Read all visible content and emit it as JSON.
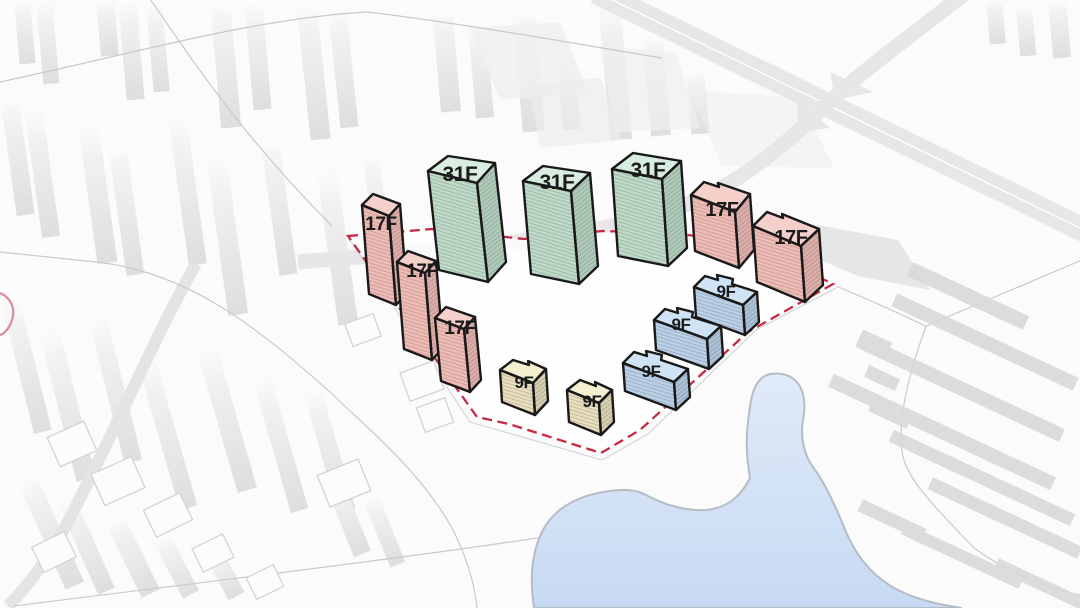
{
  "diagram": {
    "kind": "residential-site-massing-aerial-diagram",
    "site": {
      "boundary_style": "dashed",
      "boundary_color": "#c62a44"
    }
  },
  "colors": {
    "background": "#fbfbfb",
    "outline": "#191919",
    "label": "#1b1b1b",
    "boundary": "#c62a44",
    "water": "#cfdff4",
    "water_deep": "#c7daf3",
    "water_edge": "#b5bcc5",
    "road": "#e7e7e9",
    "road_line": "#c9c9cd",
    "context_building": "#d9d9db",
    "green_roof": "#d8ecdf",
    "green_face": "#bddcc9",
    "pink_roof": "#f5cfc9",
    "pink_face": "#efbdb7",
    "blue_roof": "#cfe3f4",
    "blue_face": "#b9d2ea",
    "cream_roof": "#f5efd2",
    "cream_face": "#e8e0bf"
  },
  "buildings": [
    {
      "id": "west-slab-upper",
      "label": "17F",
      "color_group": "pink"
    },
    {
      "id": "west-slab-middle",
      "label": "17F",
      "color_group": "pink"
    },
    {
      "id": "west-slab-lower",
      "label": "17F",
      "color_group": "pink"
    },
    {
      "id": "tower-west",
      "label": "31F",
      "color_group": "green"
    },
    {
      "id": "tower-center",
      "label": "31F",
      "color_group": "green"
    },
    {
      "id": "tower-east",
      "label": "31F",
      "color_group": "green"
    },
    {
      "id": "block-north",
      "label": "17F",
      "color_group": "pink"
    },
    {
      "id": "block-east",
      "label": "17F",
      "color_group": "pink"
    },
    {
      "id": "row-blue-north",
      "label": "9F",
      "color_group": "blue"
    },
    {
      "id": "row-blue-middle",
      "label": "9F",
      "color_group": "blue"
    },
    {
      "id": "row-blue-south",
      "label": "9F",
      "color_group": "blue"
    },
    {
      "id": "row-cream-west",
      "label": "9F",
      "color_group": "cream"
    },
    {
      "id": "row-cream-east",
      "label": "9F",
      "color_group": "cream"
    }
  ]
}
